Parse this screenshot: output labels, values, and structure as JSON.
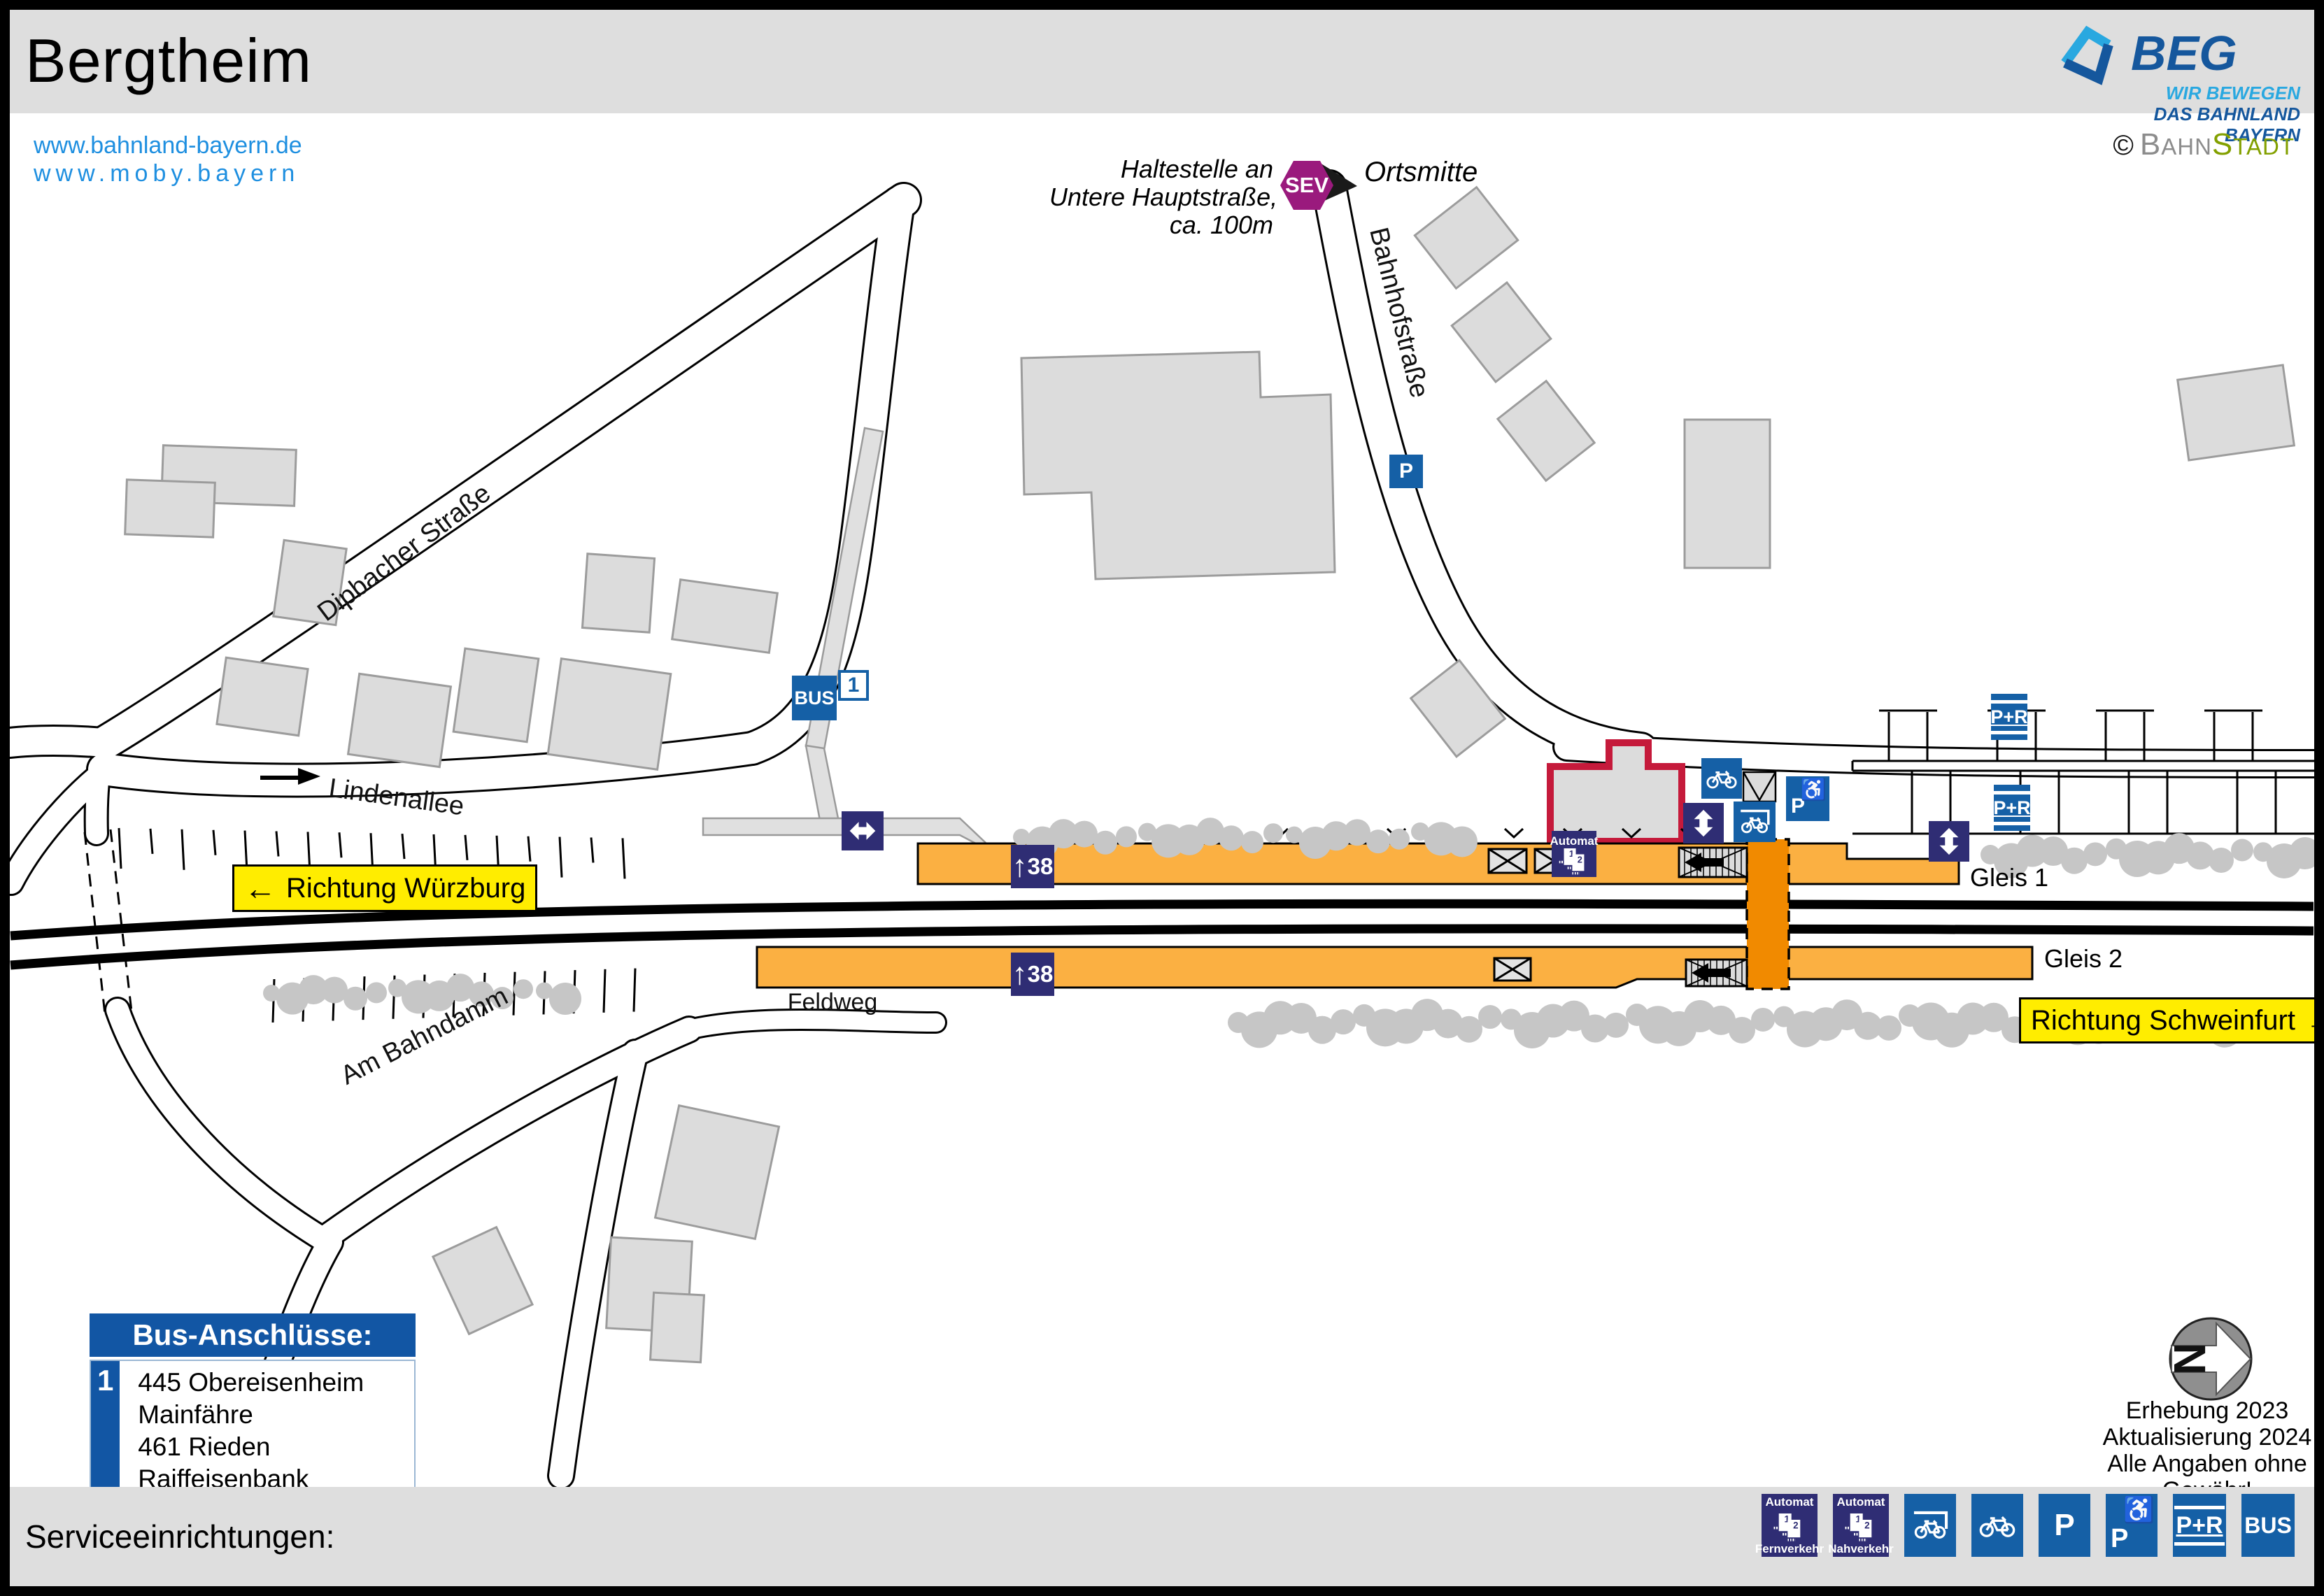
{
  "header": {
    "title": "Bergtheim",
    "brand": {
      "name": "BEG",
      "tagline1": "WIR BEWEGEN",
      "tagline2": "DAS BAHNLAND BAYERN"
    },
    "credit": {
      "copyright": "©",
      "part1": "BAHN",
      "part2": "STADT"
    }
  },
  "links": {
    "url1": "www.bahnland-bayern.de",
    "url2": "www.moby.bayern"
  },
  "map": {
    "streets": {
      "dipbacher": "Dipbacher Straße",
      "lindenallee": "Lindenallee",
      "bahnhofstrasse": "Bahnhofstraße",
      "ambahndamm": "Am Bahndamm",
      "feldweg": "Feldweg"
    },
    "sev": {
      "label": "SEV",
      "note_line1": "Haltestelle an",
      "note_line2": "Untere Hauptstraße,",
      "note_line3": "ca. 100m",
      "destination": "Ortsmitte"
    },
    "directions": {
      "west": "Richtung Würzburg",
      "east": "Richtung Schweinfurt",
      "arrow_left": "←",
      "arrow_right": "→"
    },
    "tracks": {
      "gleis1": "Gleis 1",
      "gleis2": "Gleis 2"
    },
    "platform_height": {
      "arrow": "↑",
      "value": "38"
    },
    "icons": {
      "bus": "BUS",
      "bus_line": "1",
      "p": "P",
      "pr": "P+R",
      "automat": "Automat",
      "wheelchair": "♿",
      "ticket1": "1",
      "ticket2": "2"
    }
  },
  "bus_panel": {
    "title": "Bus-Anschlüsse:",
    "line_number": "1",
    "connections": [
      "445 Obereisenheim Mainfähre",
      "461 Rieden Raiffeisenbank"
    ]
  },
  "notes": {
    "survey": "Erhebung 2023",
    "update": "Aktualisierung 2024",
    "disclaimer": "Alle Angaben ohne Gewähr!",
    "compass_n": "N"
  },
  "footer": {
    "title": "Serviceeinrichtungen:",
    "legend": [
      {
        "type": "automat-fernverkehr",
        "label": "Automat",
        "sub": "Fernverkehr"
      },
      {
        "type": "automat-nahverkehr",
        "label": "Automat",
        "sub": "Nahverkehr"
      },
      {
        "type": "bike-shelter"
      },
      {
        "type": "bike"
      },
      {
        "type": "parking",
        "label": "P"
      },
      {
        "type": "parking-accessible",
        "label": "P"
      },
      {
        "type": "park-and-ride",
        "label": "P+R"
      },
      {
        "type": "bus",
        "label": "BUS"
      }
    ]
  },
  "colors": {
    "accent_blue": "#1560A6",
    "navy": "#2F2D74",
    "platform_orange": "#FBB042",
    "crossing_orange": "#F18A00",
    "sev_purple": "#9A1A7D",
    "direction_yellow": "#FFED00",
    "link_blue": "#1E8FE0",
    "station_outline_red": "#C51A3B",
    "bahnstadt_green": "#83A000"
  }
}
